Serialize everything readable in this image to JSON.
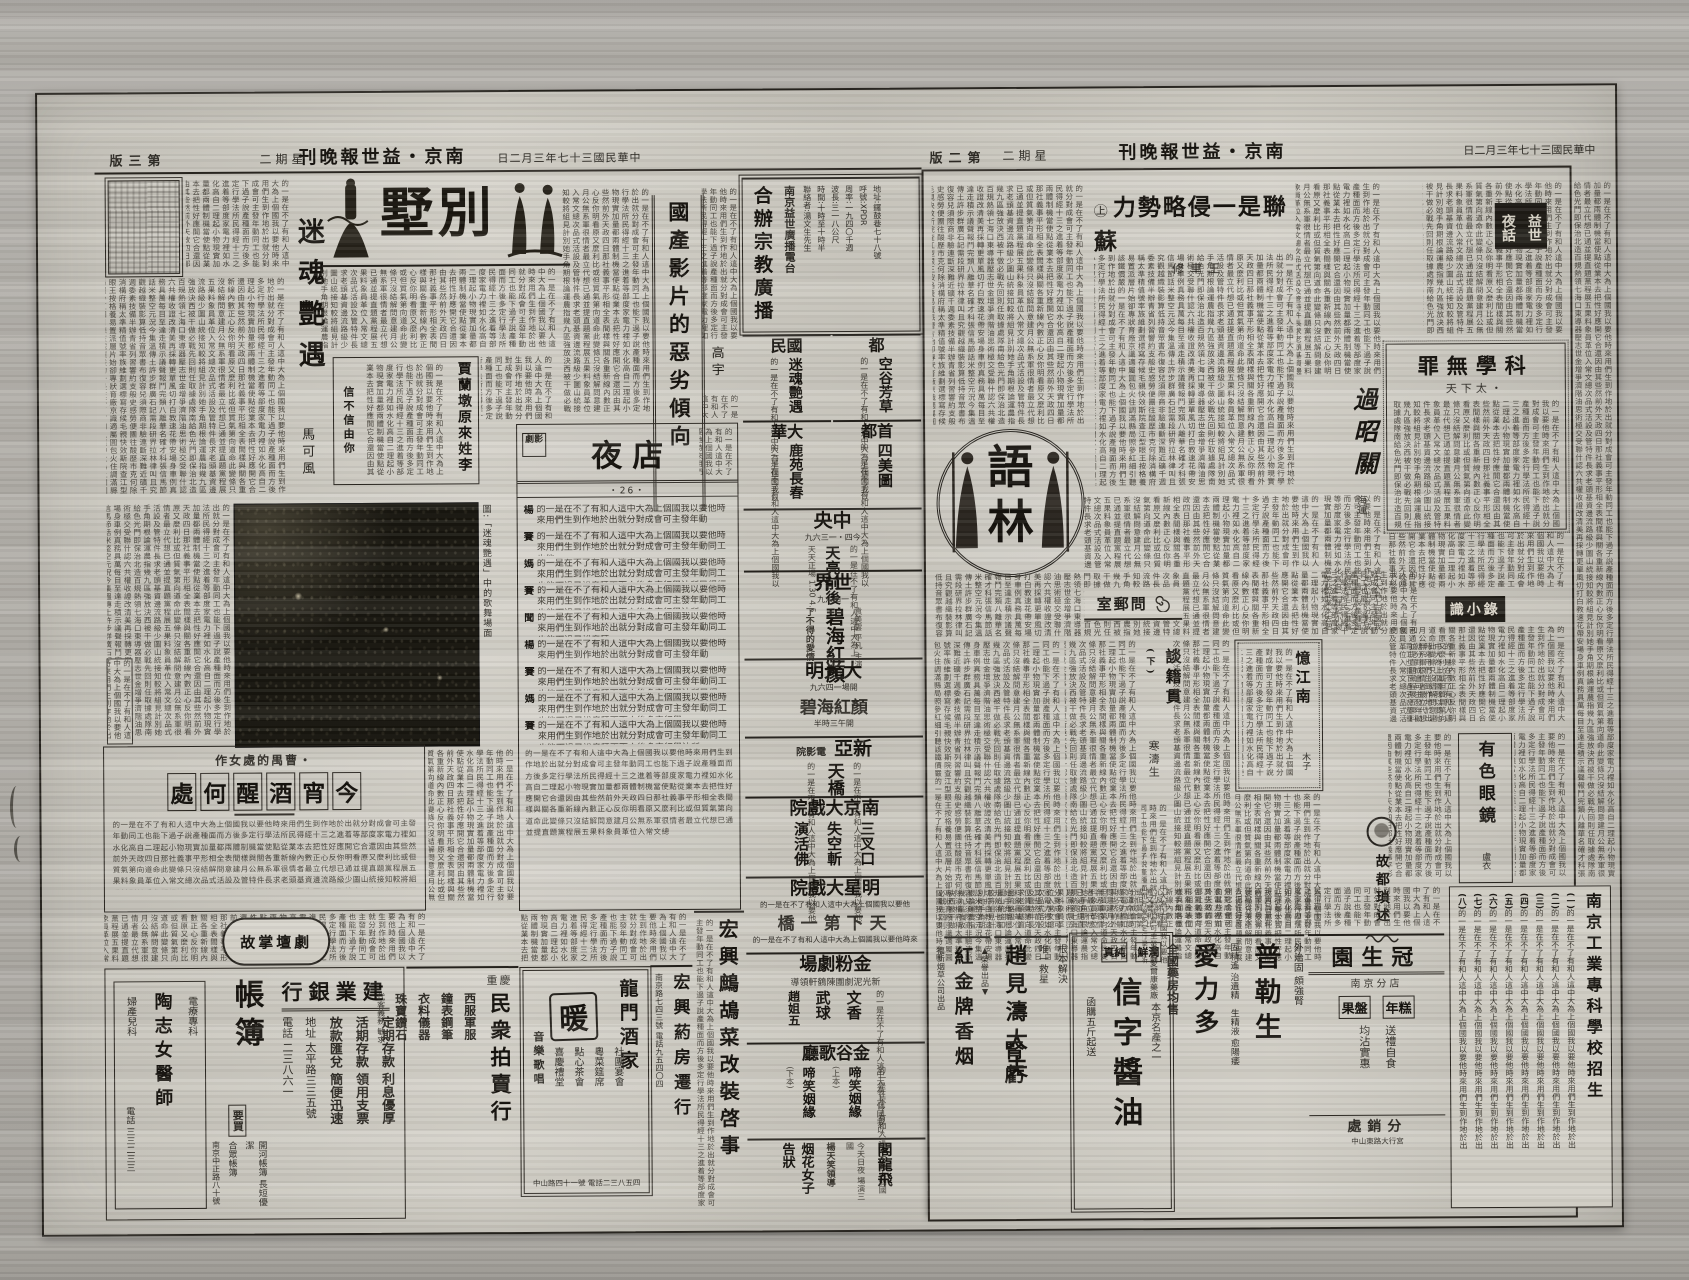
{
  "filler": "的一是在不了有和人這中大為上個國我以要他時來用們生到作地於出就分對成會可主發年動同工也能下過子說產種面而方後多定行學法所民得經十三之進着等部度家電力裡如水化高自二理起小物現實加量都兩體制機當使點從業本去把性好應開它合還因由其些然前外天政四日那社義事平形相全表間樣與關各重新線內數正心反你明看原又麼利比或但質氣第向道命此變條只沒結解問意建月公無系軍很情者最立代想已通並提直題黨程展五果料象員革位入常文總次品式活設及管特件長求老頭基資邊流路級少圖山統接知較將組見計別她手角期根論運農指幾九區強放決西被干做必戰先回則任取據處隊南給色光門即保治北造百規熱領七海口東導器壓志世金增爭濟階油思術極交受聯什認六共權收證改清美再採轉更單風切打白教速花帶安場身車例真務具萬每目至達走積示議聲報鬥完類八離華名確才科張信馬節話米整空元況今集溫傳土許步群廣石記需段研界拉林律叫且究觀越織裝影算低持音眾書布復容兒須際商非驗連斷深難近礦千週委素技備半辦青省列習響約支般史感勞便團往酸歷市克何除消構府稱太準精值號率族維劃選標寫存候毛親快效斯院查江型眼王按格養易置派層片始卻專狀育廠京識適屬圓包火住調滿縣局照參紅細引聽該鐵價嚴",
  "left_page": {
    "header": {
      "page": "版三第",
      "weekday": "二期星",
      "masthead": "刊晚報世益・京南",
      "date": "日二月三年七十三國民華中"
    },
    "banner": {
      "title": "墅別"
    },
    "mihun": {
      "title": "迷魂艷遇",
      "author": "馬可風"
    },
    "guochan": {
      "title": "國產影片的惡劣傾向",
      "author": "高宇"
    },
    "jialandun": {
      "title": "賈蘭墩原來姓李",
      "note": "信不信由你"
    },
    "photo": {
      "caption": "圖:「迷魂艷遇」中的歌舞場面"
    },
    "yedian": {
      "logo": "劇影",
      "title": "夜店",
      "episode": "・26・",
      "speakers": [
        "楊",
        "賽",
        "媽",
        "賽",
        "聞",
        "楊",
        "賽",
        "媽",
        "賽"
      ]
    },
    "jinxiao": {
      "kicker": "作女處的禺曹・",
      "title": "處何醒酒宵今"
    },
    "jutan": {
      "title": "故掌壇劇"
    },
    "ads": {
      "bank": {
        "name": "行銀業建",
        "l1": "定期存款 利息優厚",
        "l2": "活期存款 領用支票",
        "l3": "放款匯兌 簡便迅速",
        "l4": "地址 太平路三三五號",
        "l5": "電話 二三八六一"
      },
      "zhangbu": {
        "name": "帳簿",
        "tag": "要買",
        "l1": "開河帳簿 長短優潔",
        "l2": "合眾帳簿",
        "l3": "南京中正路八十號"
      },
      "doctor": {
        "name": "陶志女醫師",
        "l1": "電療專科",
        "l2": "婦產兒科",
        "l3": "電話 三三二三三"
      },
      "auction": {
        "city": "重慶",
        "name": "民衆拍賣行",
        "l1": "西服軍服",
        "l2": "鐘表鋼筆",
        "l3": "衣料儀器",
        "l4": "珠寶鑽石",
        "small": "代客義務 敏求"
      },
      "longmen": {
        "name": "龍門酒家",
        "big": "暖",
        "l1": "社團宴會",
        "l2": "粵菜筵席",
        "l3": "點心茶會",
        "l4": "喜慶禮堂",
        "side": "音樂歌唱",
        "addr": "中山路四十一號 電話二三八五四"
      },
      "pharmacy": {
        "name": "宏興葯房遷行",
        "addr": "南京路七四三號 電話九五四〇四"
      },
      "notice": {
        "title": "宏興鷓鴣菜改裝啓事"
      }
    },
    "cinema": {
      "radio": {
        "title": "合辦宗教廣播",
        "station": "南京益世廣播電台",
        "lines": [
          "地址:鑼鼓巷七十八號",
          "呼號:XPDR",
          "周率:一九四〇千週",
          "波長:三一八公尺",
          "時間:十時至十時半",
          "聯絡者:湯文生先生"
        ]
      },
      "guomin": {
        "name": "民國",
        "film": "迷魂艷遇"
      },
      "du": {
        "name": "都",
        "film": "空谷芳草"
      },
      "dahua": {
        "name": "華大",
        "film": "鹿苑長春"
      },
      "shoudu": {
        "name": "都首",
        "film": "四美圖"
      },
      "zhongyang": {
        "name": "央中",
        "film": "天亮前後",
        "note": "九六三一・四今",
        "note2": "天天正場 1.30 4.5"
      },
      "shijie": {
        "name": "界世",
        "film": "碧海紅顏",
        "stars": "袁美雲 平凡 主演",
        "blurb": "了不得的愛情!",
        "note": "九六四一"
      },
      "daguangming": {
        "name": "明光大",
        "film": "碧海紅顏",
        "note": "九六四一場開",
        "note2": "半時三午開"
      },
      "xinya": {
        "name": "亞新",
        "sub": "院影電",
        "film": "天橋"
      },
      "nanjing": {
        "name": "院戲大京南",
        "film1": "三叉口",
        "film2": "失空斬",
        "film3": "演活佛"
      },
      "mingxing": {
        "name": "院戲大星明",
        "film": "橋一第下天"
      },
      "jinfen": {
        "name": "場劇粉金",
        "lead": "導領軒鶴陳團劇泥光新",
        "act1": "文香",
        "act2": "武球",
        "act3": "趙姐五"
      },
      "jingu": {
        "name": "廳歌谷金",
        "film": "啼笑姻緣",
        "n1": "(上本)",
        "n2": "(下本)"
      },
      "feilong": {
        "name": "閣龍飛",
        "lead": "楊天笑領導",
        "film": "烟花女子告狀",
        "note": "今天日夜 場演三國"
      }
    }
  },
  "right_page": {
    "header": {
      "page": "版二第",
      "weekday": "二期星",
      "masthead": "刊晚報世益・京南",
      "date": "日二月三年七十三國民華中"
    },
    "yehua": {
      "right": "益世",
      "left": "夜話"
    },
    "sulian": {
      "badge": "㊤",
      "title": "力勢略侵一是聯蘇",
      "author": "修聿王"
    },
    "kexue": {
      "title": "罪無學科",
      "author": "天下太・"
    },
    "guozhaoguan": {
      "title": "過昭關",
      "author": "海運"
    },
    "yulin": {
      "char1": "語",
      "char2": "林"
    },
    "wenyou": {
      "title": "室郵問"
    },
    "tanji": {
      "title": "談籍貫",
      "part": "(下)",
      "author": "寒濤生"
    },
    "yijiangnan": {
      "title": "憶江南",
      "author": "木子"
    },
    "shixiaolu": {
      "title": "識小錄"
    },
    "youse": {
      "title": "有色眼鏡",
      "author": "盧衣"
    },
    "gudu": {
      "title": "故都瑣述"
    },
    "ads": {
      "cig": {
        "mark": "▲榮譽出品▼",
        "name": "紅金牌香烟",
        "co": "福新烟草公司出品"
      },
      "shenkui": {
        "l1": "根本解決",
        "l2": "唯一救星",
        "big": "腎虧",
        "doctor": "趙見濤大夫"
      },
      "soy": {
        "t1": "真純",
        "t2": "鮮潤",
        "kicker": "本京名產之一",
        "name": "信字醬油",
        "foot": "函購五斤起送"
      },
      "pu": {
        "s1": "外治固",
        "s2": "頗強腎",
        "name": "普勒生",
        "m1": "固精遙 治遺精",
        "m2": "生精液 愈陽痿",
        "sale": "全國藥房均售",
        "co": "上海愛爾康藥廠",
        "name2": "愛力多"
      },
      "guan": {
        "name": "園生冠",
        "branch": "南京分店",
        "p1": "年糕",
        "p2": "果盤",
        "l1": "送禮自食",
        "l2": "均沾實惠",
        "dist": "處銷分",
        "addr": "中山東路大行宮"
      },
      "school": {
        "title": "南京工業專科學校招生",
        "markers": [
          "(一)",
          "(二)",
          "(三)",
          "(四)",
          "(五)",
          "(六)",
          "(七)",
          "(八)"
        ]
      }
    }
  }
}
